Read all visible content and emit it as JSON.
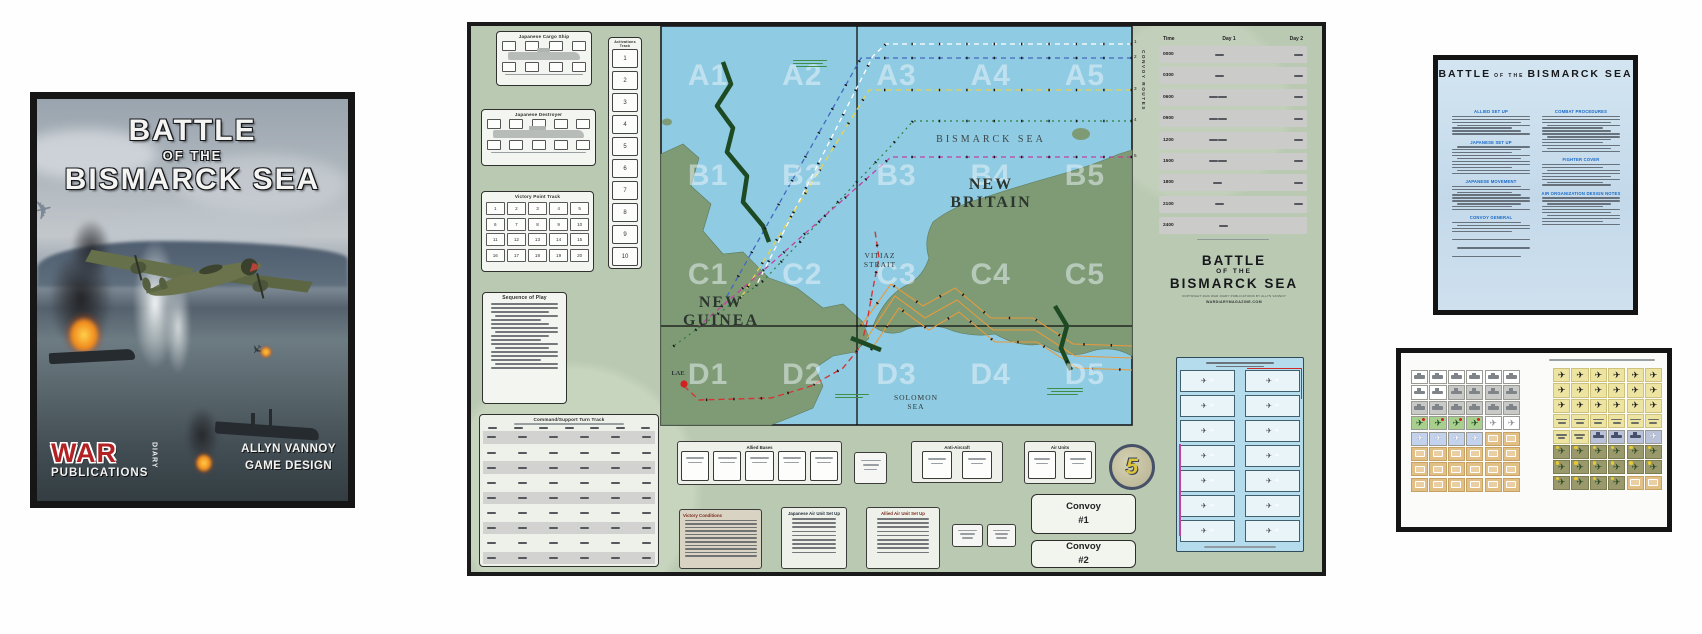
{
  "palette": {
    "sea": "#8fcbe2",
    "land": "#7e9b76",
    "map_base": "#b9c9b2",
    "route_white": "#ffffff",
    "route_blue": "#4468c0",
    "route_yellow": "#e6d44e",
    "route_green": "#2f7d3a",
    "route_magenta": "#c0429e",
    "route_orange": "#e89a3c",
    "route_red": "#d63434",
    "convoy_track_green": "#1d4a22",
    "publisher_red": "#b22225",
    "rules_heading_blue": "#1668c8",
    "counter_green": "#a9cf8e",
    "counter_blue": "#c3d3ee",
    "counter_tan": "#e2bf85",
    "counter_yellow": "#eee4a2",
    "counter_olive": "#99996b"
  },
  "cover": {
    "title": {
      "l1": "BATTLE",
      "l2": "OF THE",
      "l3": "BISMARCK SEA"
    },
    "publisher": {
      "war": "WAR",
      "diary": "DIARY",
      "publications": "PUBLICATIONS"
    },
    "credits": {
      "l1": "ALLYN VANNOY",
      "l2": "GAME DESIGN"
    }
  },
  "map": {
    "zones": [
      "A1",
      "A2",
      "A3",
      "A4",
      "A5",
      "B1",
      "B2",
      "B3",
      "B4",
      "B5",
      "C1",
      "C2",
      "C3",
      "C4",
      "C5",
      "D1",
      "D2",
      "D3",
      "D4",
      "D5"
    ],
    "places": {
      "bismarck_sea": "BISMARCK SEA",
      "new_britain": "NEW BRITAIN",
      "new_guinea": "NEW GUINEA",
      "vitiaz_strait": "VITIAZ STRAIT",
      "solomon_sea": "SOLOMON SEA",
      "lae": "LAE"
    },
    "edge_label": "CONVOY ROUTES",
    "route_numbers": [
      "1",
      "2",
      "3",
      "4",
      "5"
    ],
    "panels": {
      "cargo_title": "Japanese Cargo Ship",
      "destroyer_title": "Japanese Destroyer",
      "vp_title": "Victory Point Track",
      "vp_numbers": [
        "1",
        "2",
        "3",
        "4",
        "5",
        "6",
        "7",
        "8",
        "9",
        "10",
        "11",
        "12",
        "13",
        "14",
        "15",
        "16",
        "17",
        "18",
        "19",
        "20"
      ],
      "activations_title": "Activations Track",
      "activation_numbers": [
        "1",
        "2",
        "3",
        "4",
        "5",
        "6",
        "7",
        "8",
        "9",
        "10"
      ],
      "sequence_title": "Sequence of Play",
      "cs_title": "Command/Support Turn Track"
    },
    "turn_record": {
      "col_time": "Time",
      "col_day1": "Day 1",
      "col_day2": "Day 2",
      "times": [
        "0000",
        "0300",
        "0600",
        "0900",
        "1200",
        "1500",
        "1800",
        "2100",
        "2400"
      ]
    },
    "title_block": {
      "l1": "BATTLE",
      "l2": "OF THE",
      "l3": "BISMARCK SEA",
      "copyright": "COPYRIGHT 2020 WAR DIARY PUBLICATIONS BY ALLYN VANNOY",
      "website": "WARDIARYMAGAZINE.COM"
    },
    "bases_title": "Allied Bases",
    "aa_title": "Anti-Aircraft",
    "units_title": "Air Units",
    "convoy1": {
      "l1": "Convoy",
      "l2": "#1"
    },
    "convoy2": {
      "l1": "Convoy",
      "l2": "#2"
    },
    "emblem": "5",
    "notes": {
      "a": "Victory Conditions",
      "b": "Japanese Air Unit Set Up",
      "c": "Allied Air Unit Set Up"
    }
  },
  "rules": {
    "title": {
      "l1": "BATTLE",
      "l2": "OF THE",
      "l3": "BISMARCK SEA"
    },
    "headings_left": [
      "Allied Set Up",
      "Japanese Set Up",
      "Japanese Movement",
      "Convoy General"
    ],
    "headings_right": [
      "Combat Procedures",
      "Fighter Cover",
      "Air Organization Design Notes"
    ]
  }
}
